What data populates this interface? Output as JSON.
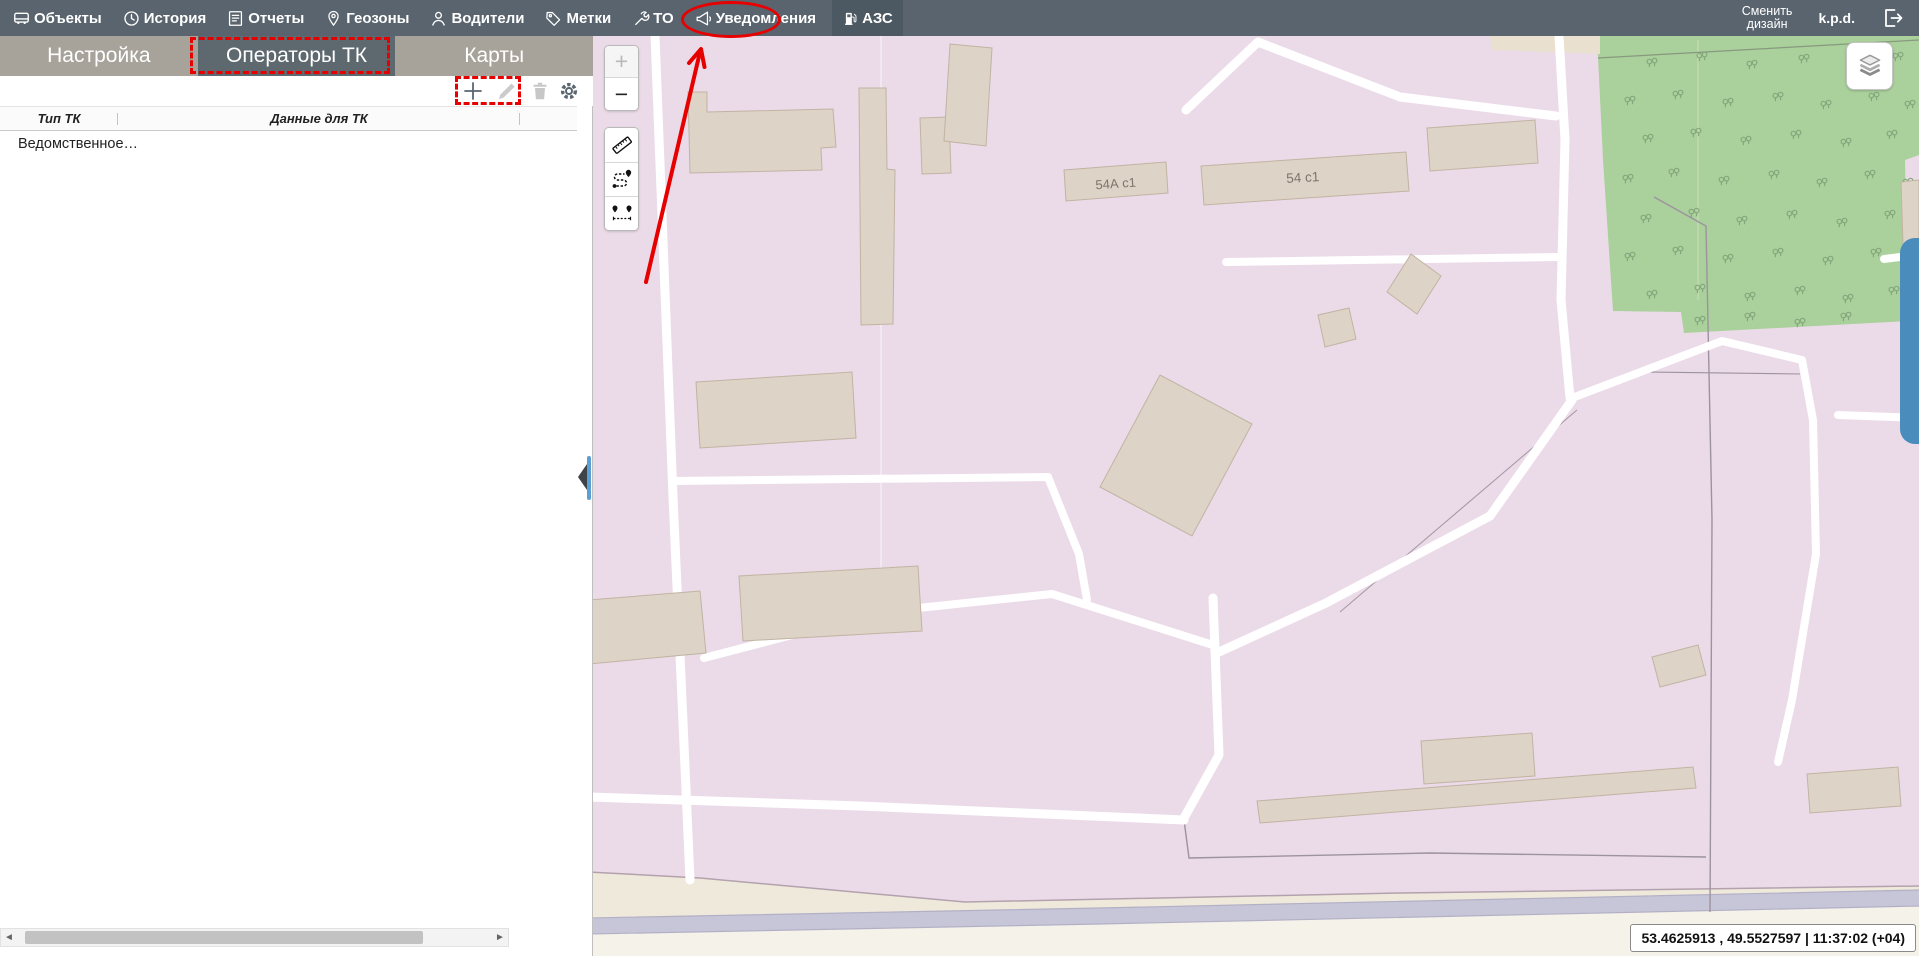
{
  "top_nav": {
    "items": [
      {
        "label": "Объекты",
        "icon": "vehicle-icon"
      },
      {
        "label": "История",
        "icon": "clock-icon"
      },
      {
        "label": "Отчеты",
        "icon": "report-icon"
      },
      {
        "label": "Геозоны",
        "icon": "geofence-icon"
      },
      {
        "label": "Водители",
        "icon": "driver-icon"
      },
      {
        "label": "Метки",
        "icon": "tag-icon"
      },
      {
        "label": "ТО",
        "icon": "wrench-icon"
      },
      {
        "label": "Уведомления",
        "icon": "megaphone-icon"
      },
      {
        "label": "АЗС",
        "icon": "fuel-pump-icon",
        "selected": true,
        "annotated": "red-ellipse"
      }
    ],
    "change_design_line1": "Сменить",
    "change_design_line2": "дизайн",
    "username": "k.p.d.",
    "logout_icon": "logout-icon"
  },
  "sidebar": {
    "tabs": [
      {
        "label": "Настройка"
      },
      {
        "label": "Операторы ТК",
        "active": true,
        "annotated": "red-dashed-box"
      },
      {
        "label": "Карты"
      }
    ],
    "toolbar": {
      "add_icon": "plus-icon",
      "edit_icon": "pencil-icon",
      "delete_icon": "trash-icon",
      "settings_icon": "gear-icon",
      "annotated": "red-dashed-box-around-add-and-edit"
    },
    "table": {
      "columns": [
        "Тип ТК",
        "Данные для ТК"
      ],
      "rows": [
        [
          "Ведомственное…",
          ""
        ]
      ]
    }
  },
  "map": {
    "zoom_in": "+",
    "zoom_out": "−",
    "tool_icons": [
      "ruler-icon",
      "route-icon",
      "distance-icon"
    ],
    "layers_icon": "layers-icon",
    "building_labels": [
      "54А с1",
      "54 с1"
    ],
    "status_bar": "53.4625913 , 49.5527597  |  11:37:02 (+04)",
    "colors": {
      "land": "#ebdbe8",
      "building": "#ddd3c6",
      "building_border": "#c2b3a3",
      "road": "#ffffff",
      "forest": "#aad09b",
      "highway": "#c7c6d8",
      "highway_band": "#efe9dc",
      "accent_blue": "#4a8cbc",
      "annotation_red": "#e60000"
    }
  }
}
